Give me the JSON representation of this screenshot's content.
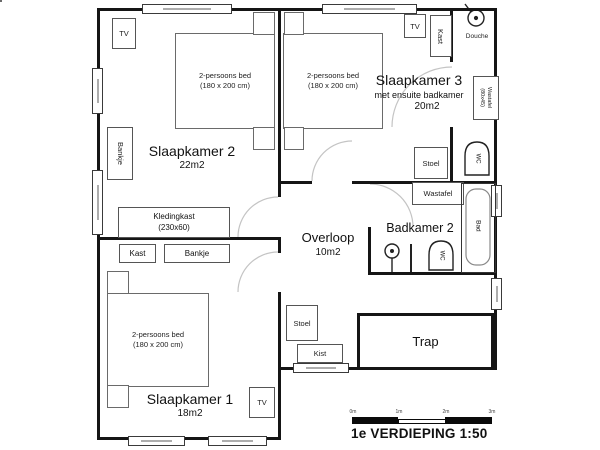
{
  "plan": {
    "rooms": {
      "slaapkamer2": {
        "name": "Slaapkamer 2",
        "area": "22m2"
      },
      "slaapkamer3": {
        "name": "Slaapkamer 3",
        "subtitle": "met ensuite badkamer",
        "area": "20m2"
      },
      "slaapkamer1": {
        "name": "Slaapkamer 1",
        "area": "18m2"
      },
      "overloop": {
        "name": "Overloop",
        "area": "10m2"
      },
      "badkamer2": {
        "name": "Badkamer 2"
      },
      "trap": {
        "name": "Trap"
      }
    },
    "furniture": {
      "bed_line1": "2-persoons bed",
      "bed_line2": "(180 x 200 cm)",
      "tv": "TV",
      "kast": "Kast",
      "bankje": "Bankje",
      "kledingkast_line1": "Kledingkast",
      "kledingkast_line2": "(230x60)",
      "stoel": "Stoel",
      "kist": "Kist",
      "wastafel": "Wastafel",
      "wastafel_ensuite_line1": "Wastafel",
      "wastafel_ensuite_line2": "(80x45)",
      "douche": "Douche",
      "wc": "WC",
      "bad": "Bad"
    },
    "scale_bar": {
      "labels": [
        "0m",
        "1m",
        "2m",
        "3m"
      ]
    },
    "title": "1e VERDIEPING 1:50"
  }
}
